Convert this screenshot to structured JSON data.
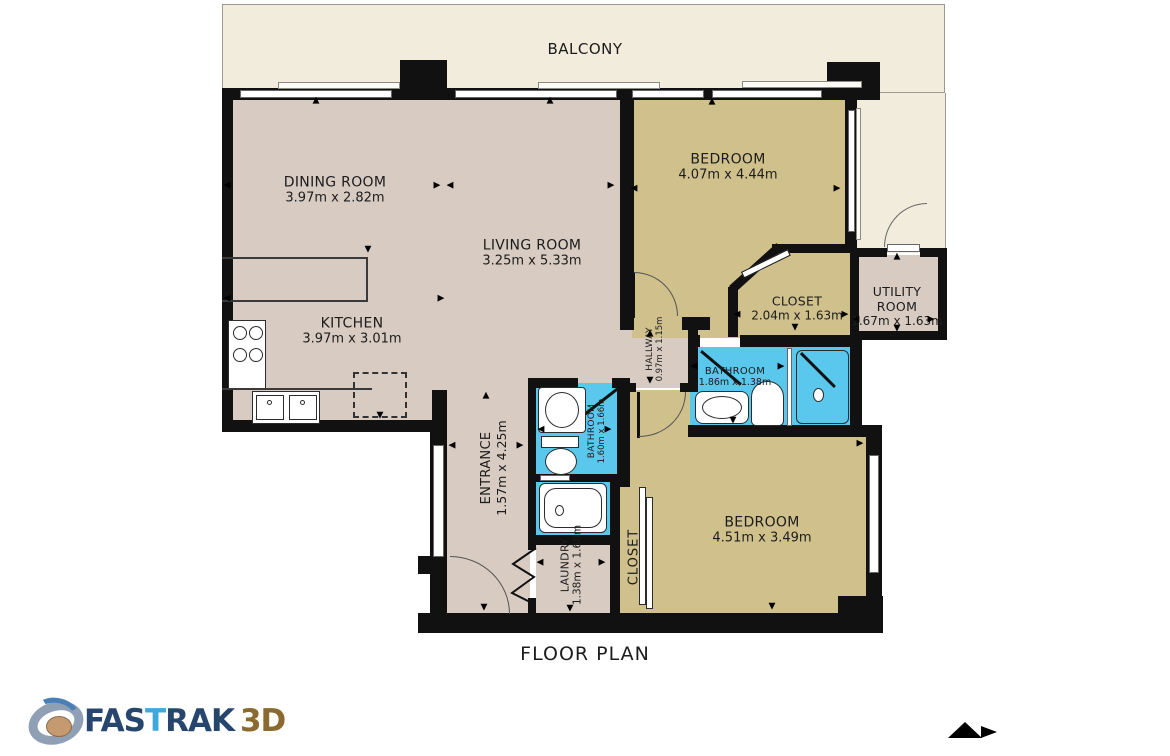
{
  "title": "FLOOR PLAN",
  "balcony_label": "BALCONY",
  "rooms": {
    "dining": {
      "name": "DINING ROOM",
      "dims": "3.97m x 2.82m"
    },
    "living": {
      "name": "LIVING ROOM",
      "dims": "3.25m x 5.33m"
    },
    "kitchen": {
      "name": "KITCHEN",
      "dims": "3.97m x 3.01m"
    },
    "bedroom1": {
      "name": "BEDROOM",
      "dims": "4.07m x 4.44m"
    },
    "closet1": {
      "name": "CLOSET",
      "dims": "2.04m x 1.63m"
    },
    "utility": {
      "name": "UTILITY ROOM",
      "dims": "1.67m x 1.63m"
    },
    "hallway": {
      "name": "HALLWAY",
      "dims": "0.97m x 1.15m"
    },
    "bathroom_main": {
      "name": "BATHROOM",
      "dims": "1.86m x 1.38m"
    },
    "bathroom_ensuite": {
      "name": "BATHROOM",
      "dims": "1.60m x 1.66m"
    },
    "entrance": {
      "name": "ENTRANCE",
      "dims": "1.57m x 4.25m"
    },
    "laundry": {
      "name": "LAUNDRY",
      "dims": "1.38m x 1.68m"
    },
    "closet2": {
      "name": "CLOSET"
    },
    "bedroom2": {
      "name": "BEDROOM",
      "dims": "4.51m x 3.49m"
    }
  },
  "logo": {
    "text_fas": "FAS",
    "text_t": "T",
    "text_rak": "RAK",
    "text_3d": "3D"
  },
  "colors": {
    "floor_pink": "#d8cbc2",
    "floor_tan": "#cfc08c",
    "floor_blue": "#5ac7ec",
    "balcony_cream": "#f1ecdc",
    "wall": "#111111",
    "logo_navy": "#27466e",
    "logo_light_blue": "#3fa9dc",
    "logo_gold": "#8a6a2e"
  }
}
